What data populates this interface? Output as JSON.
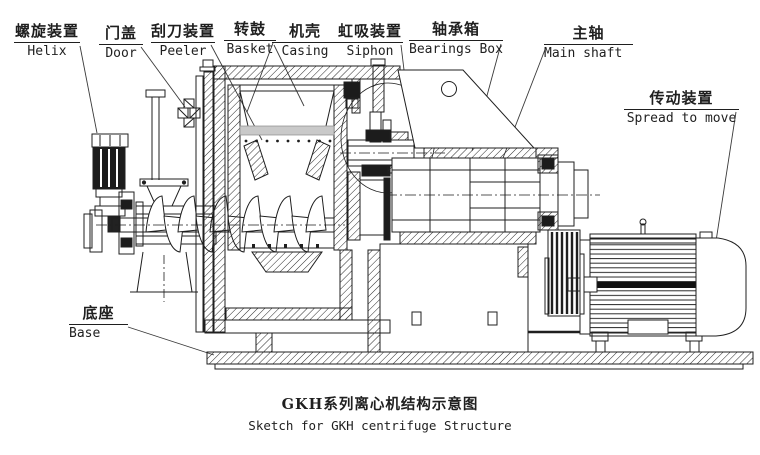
{
  "diagram": {
    "type": "technical-drawing",
    "labels": [
      {
        "zh": "螺旋装置",
        "en": "Helix"
      },
      {
        "zh": "门盖",
        "en": "Door"
      },
      {
        "zh": "刮刀装置",
        "en": "Peeler"
      },
      {
        "zh": "转鼓",
        "en": "Basket"
      },
      {
        "zh": "机壳",
        "en": "Casing"
      },
      {
        "zh": "虹吸装置",
        "en": "Siphon"
      },
      {
        "zh": "轴承箱",
        "en": "Bearings Box"
      },
      {
        "zh": "主轴",
        "en": "Main shaft"
      },
      {
        "zh": "传动装置",
        "en": "Spread to move"
      },
      {
        "zh": "底座",
        "en": "Base"
      }
    ],
    "caption": {
      "zh": "GKH系列离心机结构示意图",
      "en": "Sketch for GKH centrifuge Structure"
    },
    "colors": {
      "line": "#1f1f1f",
      "background": "#ffffff",
      "shade": "#c9c9c9"
    }
  }
}
